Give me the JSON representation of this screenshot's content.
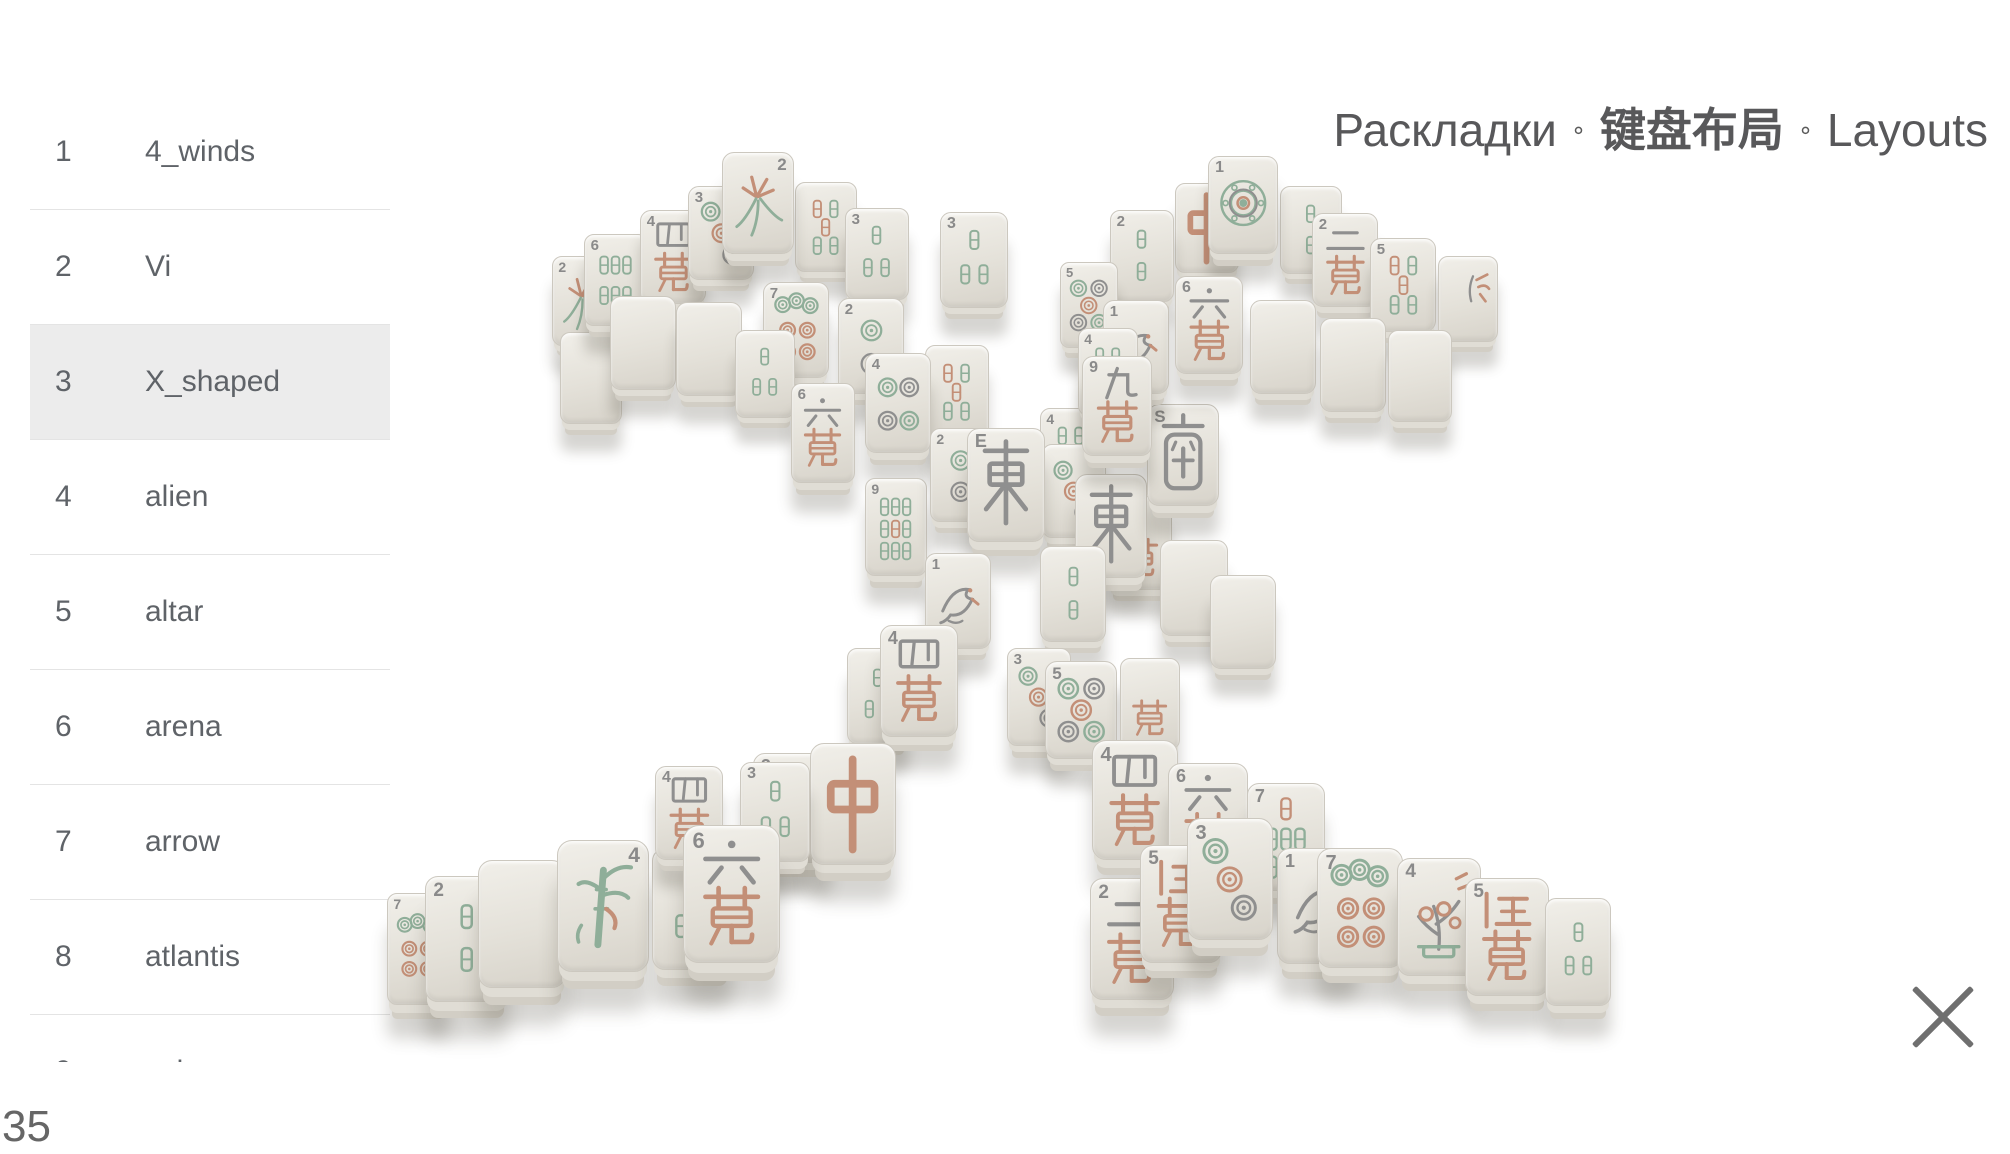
{
  "header": {
    "title_ru": "Раскладки",
    "title_zh": "键盘布局",
    "title_en": "Layouts",
    "separator": "∘"
  },
  "sidebar": {
    "selected_index": 2,
    "items": [
      {
        "num": "1",
        "label": "4_winds"
      },
      {
        "num": "2",
        "label": "Vi"
      },
      {
        "num": "3",
        "label": "X_shaped"
      },
      {
        "num": "4",
        "label": "alien"
      },
      {
        "num": "5",
        "label": "altar"
      },
      {
        "num": "6",
        "label": "arena"
      },
      {
        "num": "7",
        "label": "arrow"
      },
      {
        "num": "8",
        "label": "atlantis"
      },
      {
        "num": "9",
        "label": "axis"
      }
    ]
  },
  "footer": {
    "layout_count": "35"
  },
  "colors": {
    "face": "#e8e5de",
    "face_dark": "#d6d2c9",
    "green": "#8fae99",
    "salmon": "#c38f77",
    "gray": "#8f8f8f",
    "text": "#5f6368",
    "highlight": "#ececec"
  },
  "scene": {
    "layout_name": "X_shaped",
    "tiles": [
      {
        "x": 552,
        "y": 256,
        "w": 62,
        "h": 90,
        "t": "orchid",
        "n": "2"
      },
      {
        "x": 560,
        "y": 332,
        "w": 62,
        "h": 92,
        "t": "blank"
      },
      {
        "x": 584,
        "y": 234,
        "w": 64,
        "h": 92,
        "t": "bams6",
        "n": "6"
      },
      {
        "x": 640,
        "y": 210,
        "w": 66,
        "h": 94,
        "t": "man4",
        "n": "4"
      },
      {
        "x": 688,
        "y": 186,
        "w": 66,
        "h": 94,
        "t": "dots3",
        "n": "3"
      },
      {
        "x": 795,
        "y": 182,
        "w": 62,
        "h": 90,
        "t": "bmix5"
      },
      {
        "x": 845,
        "y": 208,
        "w": 64,
        "h": 92,
        "t": "bams3",
        "n": "3"
      },
      {
        "x": 940,
        "y": 212,
        "w": 68,
        "h": 96,
        "t": "bams3",
        "n": "3"
      },
      {
        "x": 722,
        "y": 152,
        "w": 72,
        "h": 102,
        "t": "orchid",
        "n": "2",
        "np": "tr"
      },
      {
        "x": 610,
        "y": 296,
        "w": 66,
        "h": 94,
        "t": "blank"
      },
      {
        "x": 676,
        "y": 302,
        "w": 66,
        "h": 94,
        "t": "blank"
      },
      {
        "x": 763,
        "y": 282,
        "w": 66,
        "h": 96,
        "t": "dots7",
        "n": "7"
      },
      {
        "x": 838,
        "y": 298,
        "w": 66,
        "h": 96,
        "t": "dots2",
        "n": "2"
      },
      {
        "x": 925,
        "y": 345,
        "w": 64,
        "h": 94,
        "t": "bmix5"
      },
      {
        "x": 735,
        "y": 330,
        "w": 60,
        "h": 88,
        "t": "bams3"
      },
      {
        "x": 865,
        "y": 353,
        "w": 66,
        "h": 100,
        "t": "dots4",
        "n": "4"
      },
      {
        "x": 791,
        "y": 383,
        "w": 64,
        "h": 100,
        "t": "man6",
        "n": "6"
      },
      {
        "x": 865,
        "y": 478,
        "w": 62,
        "h": 98,
        "t": "bams9",
        "n": "9"
      },
      {
        "x": 1040,
        "y": 408,
        "w": 62,
        "h": 88,
        "t": "bams4",
        "n": "4"
      },
      {
        "x": 930,
        "y": 428,
        "w": 62,
        "h": 94,
        "t": "dots2",
        "n": "2"
      },
      {
        "x": 1042,
        "y": 444,
        "w": 64,
        "h": 94,
        "t": "dots3"
      },
      {
        "x": 1108,
        "y": 496,
        "w": 64,
        "h": 94,
        "t": "manx"
      },
      {
        "x": 1075,
        "y": 474,
        "w": 72,
        "h": 104,
        "t": "east"
      },
      {
        "x": 1147,
        "y": 404,
        "w": 72,
        "h": 102,
        "t": "south",
        "n": "S"
      },
      {
        "x": 967,
        "y": 428,
        "w": 78,
        "h": 114,
        "t": "east",
        "n": "E"
      },
      {
        "x": 1160,
        "y": 540,
        "w": 68,
        "h": 96,
        "t": "blank"
      },
      {
        "x": 1210,
        "y": 575,
        "w": 66,
        "h": 94,
        "t": "blank"
      },
      {
        "x": 925,
        "y": 553,
        "w": 66,
        "h": 96,
        "t": "bird",
        "n": "1"
      },
      {
        "x": 1040,
        "y": 546,
        "w": 66,
        "h": 96,
        "t": "bams2"
      },
      {
        "x": 847,
        "y": 648,
        "w": 62,
        "h": 96,
        "t": "bams3"
      },
      {
        "x": 880,
        "y": 625,
        "w": 78,
        "h": 112,
        "t": "man4",
        "n": "4"
      },
      {
        "x": 1007,
        "y": 648,
        "w": 64,
        "h": 98,
        "t": "dots3",
        "n": "3"
      },
      {
        "x": 1045,
        "y": 661,
        "w": 72,
        "h": 98,
        "t": "dots5",
        "n": "5"
      },
      {
        "x": 1120,
        "y": 658,
        "w": 60,
        "h": 92,
        "t": "manx"
      },
      {
        "x": 753,
        "y": 753,
        "w": 78,
        "h": 110,
        "t": "bams3",
        "n": "3"
      },
      {
        "x": 810,
        "y": 743,
        "w": 86,
        "h": 122,
        "t": "zhong"
      },
      {
        "x": 1092,
        "y": 740,
        "w": 86,
        "h": 120,
        "t": "man4",
        "n": "4"
      },
      {
        "x": 1175,
        "y": 183,
        "w": 64,
        "h": 90,
        "t": "zhong"
      },
      {
        "x": 1110,
        "y": 210,
        "w": 64,
        "h": 92,
        "t": "bams2",
        "n": "2"
      },
      {
        "x": 1280,
        "y": 186,
        "w": 62,
        "h": 88,
        "t": "bams2"
      },
      {
        "x": 1312,
        "y": 213,
        "w": 66,
        "h": 94,
        "t": "man2",
        "n": "2"
      },
      {
        "x": 1370,
        "y": 238,
        "w": 66,
        "h": 94,
        "t": "bmix5",
        "n": "5"
      },
      {
        "x": 1438,
        "y": 256,
        "w": 60,
        "h": 86,
        "t": "autumn"
      },
      {
        "x": 1208,
        "y": 156,
        "w": 70,
        "h": 98,
        "t": "dots1",
        "n": "1"
      },
      {
        "x": 1060,
        "y": 262,
        "w": 58,
        "h": 86,
        "t": "dots5",
        "n": "5"
      },
      {
        "x": 1103,
        "y": 300,
        "w": 66,
        "h": 94,
        "t": "bird",
        "n": "1"
      },
      {
        "x": 1175,
        "y": 276,
        "w": 68,
        "h": 98,
        "t": "man6",
        "n": "6"
      },
      {
        "x": 1078,
        "y": 328,
        "w": 60,
        "h": 88,
        "t": "bams4",
        "n": "4"
      },
      {
        "x": 1082,
        "y": 356,
        "w": 70,
        "h": 100,
        "t": "man9",
        "n": "9"
      },
      {
        "x": 1250,
        "y": 300,
        "w": 66,
        "h": 94,
        "t": "blank"
      },
      {
        "x": 1320,
        "y": 318,
        "w": 66,
        "h": 94,
        "t": "blank"
      },
      {
        "x": 1388,
        "y": 330,
        "w": 64,
        "h": 92,
        "t": "blank"
      },
      {
        "x": 387,
        "y": 893,
        "w": 62,
        "h": 112,
        "t": "dots7",
        "n": "7"
      },
      {
        "x": 425,
        "y": 876,
        "w": 84,
        "h": 126,
        "t": "bams2",
        "n": "2"
      },
      {
        "x": 478,
        "y": 860,
        "w": 88,
        "h": 128,
        "t": "blank"
      },
      {
        "x": 557,
        "y": 840,
        "w": 92,
        "h": 132,
        "t": "plant",
        "n": "4",
        "np": "tr"
      },
      {
        "x": 652,
        "y": 848,
        "w": 80,
        "h": 122,
        "t": "bams3",
        "n": "3"
      },
      {
        "x": 655,
        "y": 766,
        "w": 68,
        "h": 94,
        "t": "man4",
        "n": "4"
      },
      {
        "x": 740,
        "y": 762,
        "w": 70,
        "h": 100,
        "t": "bams3",
        "n": "3"
      },
      {
        "x": 683,
        "y": 825,
        "w": 97,
        "h": 138,
        "t": "man6",
        "n": "6"
      },
      {
        "x": 1168,
        "y": 763,
        "w": 80,
        "h": 112,
        "t": "man6",
        "n": "6"
      },
      {
        "x": 1247,
        "y": 783,
        "w": 78,
        "h": 108,
        "t": "bams7",
        "n": "7"
      },
      {
        "x": 1090,
        "y": 878,
        "w": 84,
        "h": 122,
        "t": "man2",
        "n": "2"
      },
      {
        "x": 1140,
        "y": 845,
        "w": 82,
        "h": 118,
        "t": "man5",
        "n": "5"
      },
      {
        "x": 1277,
        "y": 848,
        "w": 80,
        "h": 116,
        "t": "bird",
        "n": "1"
      },
      {
        "x": 1317,
        "y": 848,
        "w": 86,
        "h": 120,
        "t": "dots7",
        "n": "7"
      },
      {
        "x": 1397,
        "y": 858,
        "w": 84,
        "h": 118,
        "t": "winter",
        "n": "4"
      },
      {
        "x": 1465,
        "y": 878,
        "w": 84,
        "h": 118,
        "t": "man5",
        "n": "5"
      },
      {
        "x": 1545,
        "y": 898,
        "w": 66,
        "h": 108,
        "t": "bams3"
      },
      {
        "x": 1187,
        "y": 818,
        "w": 86,
        "h": 122,
        "t": "dots3",
        "n": "3"
      }
    ]
  }
}
